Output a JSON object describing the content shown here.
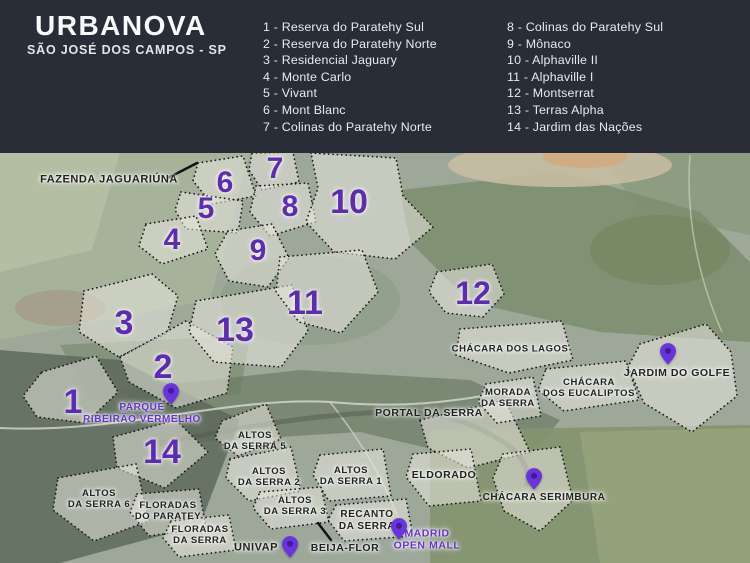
{
  "header": {
    "title": "URBANOVA",
    "subtitle": "SÃO JOSÉ DOS CAMPOS - SP",
    "bg_color": "#282d37",
    "text_color": "#fafbfc"
  },
  "legend": {
    "column1": [
      "1 - Reserva do Paratehy Sul",
      "2 - Reserva do Paratehy Norte",
      "3 - Residencial Jaguary",
      "4 - Monte Carlo",
      "5 - Vivant",
      "6 - Mont Blanc",
      "7 - Colinas do Paratehy Norte"
    ],
    "column2": [
      "8 - Colinas do Paratehy Sul",
      "9 - Mônaco",
      "10 - Alphaville II",
      "11 - Alphaville I",
      "12 - Montserrat",
      "13 - Terras Alpha",
      "14 - Jardim das Nações"
    ]
  },
  "map": {
    "accent_color": "#5c2db3",
    "pin_color": "#6a34dd",
    "pin_dot_color": "#3f1e8f",
    "outline_color": "#16171a",
    "numbers": [
      {
        "label": "1",
        "x": 73,
        "y": 402,
        "size": 34
      },
      {
        "label": "2",
        "x": 163,
        "y": 367,
        "size": 34
      },
      {
        "label": "3",
        "x": 124,
        "y": 323,
        "size": 34
      },
      {
        "label": "4",
        "x": 172,
        "y": 240,
        "size": 30
      },
      {
        "label": "5",
        "x": 206,
        "y": 209,
        "size": 30
      },
      {
        "label": "6",
        "x": 225,
        "y": 183,
        "size": 30
      },
      {
        "label": "7",
        "x": 275,
        "y": 169,
        "size": 30
      },
      {
        "label": "8",
        "x": 290,
        "y": 207,
        "size": 30
      },
      {
        "label": "9",
        "x": 258,
        "y": 251,
        "size": 30
      },
      {
        "label": "10",
        "x": 349,
        "y": 202,
        "size": 34
      },
      {
        "label": "11",
        "x": 305,
        "y": 303,
        "size": 34
      },
      {
        "label": "12",
        "x": 473,
        "y": 293,
        "size": 32
      },
      {
        "label": "13",
        "x": 235,
        "y": 330,
        "size": 34
      },
      {
        "label": "14",
        "x": 162,
        "y": 452,
        "size": 34
      }
    ],
    "labels": [
      {
        "name": "fazenda-jaguariuna-label",
        "lines": [
          "FAZENDA JAGUARIÚNA"
        ],
        "x": 109,
        "y": 180,
        "color": "dark",
        "size": 11
      },
      {
        "name": "parque-ribeirao-vermelho-label",
        "lines": [
          "PARQUE",
          "RIBEIRÃO VERMELHO"
        ],
        "x": 142,
        "y": 414,
        "color": "purple",
        "size": 10
      },
      {
        "name": "chacara-dos-lagos-label",
        "lines": [
          "CHÁCARA DOS LAGOS"
        ],
        "x": 510,
        "y": 349,
        "color": "dark",
        "size": 9.5
      },
      {
        "name": "jardim-do-golfe-label",
        "lines": [
          "JARDIM DO GOLFE"
        ],
        "x": 677,
        "y": 373,
        "color": "dark",
        "size": 10.5
      },
      {
        "name": "chacara-dos-eucaliptos-label",
        "lines": [
          "CHÁCARA",
          "DOS EUCALIPTOS"
        ],
        "x": 589,
        "y": 388,
        "color": "dark",
        "size": 9.5
      },
      {
        "name": "morada-da-serra-label",
        "lines": [
          "MORADA",
          "DA SERRA"
        ],
        "x": 508,
        "y": 398,
        "color": "dark",
        "size": 9.5
      },
      {
        "name": "portal-da-serra-label",
        "lines": [
          "PORTAL DA SERRA"
        ],
        "x": 429,
        "y": 413,
        "color": "dark",
        "size": 10.5
      },
      {
        "name": "altos-da-serra-5-label",
        "lines": [
          "ALTOS",
          "DA SERRA 5"
        ],
        "x": 255,
        "y": 441,
        "color": "dark",
        "size": 9.5
      },
      {
        "name": "altos-da-serra-2-label",
        "lines": [
          "ALTOS",
          "DA SERRA 2"
        ],
        "x": 269,
        "y": 477,
        "color": "dark",
        "size": 9.5
      },
      {
        "name": "altos-da-serra-1-label",
        "lines": [
          "ALTOS",
          "DA SERRA 1"
        ],
        "x": 351,
        "y": 476,
        "color": "dark",
        "size": 9.5
      },
      {
        "name": "eldorado-label",
        "lines": [
          "ELDORADO"
        ],
        "x": 444,
        "y": 475,
        "color": "dark",
        "size": 10.5
      },
      {
        "name": "altos-da-serra-3-label",
        "lines": [
          "ALTOS",
          "DA SERRA 3"
        ],
        "x": 295,
        "y": 506,
        "color": "dark",
        "size": 9.5
      },
      {
        "name": "recanto-da-serra-label",
        "lines": [
          "RECANTO",
          "DA SERRA"
        ],
        "x": 367,
        "y": 521,
        "color": "dark",
        "size": 10
      },
      {
        "name": "altos-da-serra-6-label",
        "lines": [
          "ALTOS",
          "DA SERRA 6"
        ],
        "x": 99,
        "y": 499,
        "color": "dark",
        "size": 9.5
      },
      {
        "name": "floradas-do-paratey-label",
        "lines": [
          "FLORADAS",
          "DO PARATEY"
        ],
        "x": 168,
        "y": 511,
        "color": "dark",
        "size": 9.5
      },
      {
        "name": "floradas-da-serra-label",
        "lines": [
          "FLORADAS",
          "DA SERRA"
        ],
        "x": 200,
        "y": 535,
        "color": "dark",
        "size": 9.5
      },
      {
        "name": "univap-label",
        "lines": [
          "UNIVAP"
        ],
        "x": 256,
        "y": 548,
        "color": "dark",
        "size": 11
      },
      {
        "name": "beija-flor-label",
        "lines": [
          "BEIJA-FLOR"
        ],
        "x": 345,
        "y": 548,
        "color": "dark",
        "size": 10.5
      },
      {
        "name": "madrid-open-mall-label",
        "lines": [
          "MADRID",
          "OPEN MALL"
        ],
        "x": 427,
        "y": 540,
        "color": "purple",
        "size": 10.5
      },
      {
        "name": "chacara-serimbura-label",
        "lines": [
          "CHÁCARA SERIMBURA"
        ],
        "x": 544,
        "y": 498,
        "color": "dark",
        "size": 10
      }
    ],
    "pins": [
      {
        "name": "parque-ribeirao-vermelho-pin",
        "x": 171,
        "y": 403
      },
      {
        "name": "jardim-do-golfe-pin",
        "x": 668,
        "y": 363
      },
      {
        "name": "chacara-serimbura-pin",
        "x": 534,
        "y": 488
      },
      {
        "name": "univap-pin",
        "x": 290,
        "y": 556
      },
      {
        "name": "madrid-open-mall-pin",
        "x": 399,
        "y": 538
      }
    ],
    "pointer_lines": [
      {
        "name": "fazenda-jaguariuna-pointer",
        "x1": 168,
        "y1": 178,
        "x2": 197,
        "y2": 163
      },
      {
        "name": "beija-flor-pointer",
        "x1": 318,
        "y1": 523,
        "x2": 331,
        "y2": 540
      }
    ],
    "regions": [
      {
        "name": "region-7-outline",
        "points": "252,153 293,152 299,182 262,190 249,170"
      },
      {
        "name": "region-6-outline",
        "points": "198,163 243,156 256,196 212,204 193,181"
      },
      {
        "name": "region-5-outline",
        "points": "181,192 243,201 238,233 186,229 175,210"
      },
      {
        "name": "region-4-outline",
        "points": "146,224 196,216 208,249 162,264 139,246"
      },
      {
        "name": "region-8-outline",
        "points": "256,186 308,183 316,222 270,236 250,212"
      },
      {
        "name": "region-10-outline",
        "points": "311,153 396,158 403,196 433,227 395,259 334,252 306,222 318,188"
      },
      {
        "name": "region-9-outline",
        "points": "228,231 272,224 289,258 268,287 229,281 215,254"
      },
      {
        "name": "region-12-outline",
        "points": "437,272 492,264 504,294 483,317 446,313 429,292"
      },
      {
        "name": "region-3-outline",
        "points": "84,291 152,274 178,296 167,333 119,357 79,332"
      },
      {
        "name": "region-2-outline",
        "points": "120,357 186,321 233,347 227,393 176,408 129,382"
      },
      {
        "name": "region-1-outline",
        "points": "42,372 96,356 118,392 86,423 37,417 23,396"
      },
      {
        "name": "region-14-outline",
        "points": "113,437 176,420 208,452 165,488 117,468"
      },
      {
        "name": "region-13-outline",
        "points": "196,301 292,285 308,331 281,367 214,362 189,332"
      },
      {
        "name": "region-11-outline",
        "points": "280,257 362,250 378,292 341,333 299,322 276,292"
      },
      {
        "name": "portal-da-serra-outline",
        "points": "420,420 505,400 530,452 468,468 428,448"
      },
      {
        "name": "altos-da-serra-5-outline",
        "points": "222,421 266,404 281,439 238,456 215,438"
      },
      {
        "name": "altos-da-serra-2-outline",
        "points": "230,459 291,447 301,491 249,501 226,478"
      },
      {
        "name": "altos-da-serra-1-outline",
        "points": "320,455 383,449 391,496 329,501 313,475"
      },
      {
        "name": "altos-da-serra-3-outline",
        "points": "260,492 321,487 329,522 271,529 253,508"
      },
      {
        "name": "altos-da-serra-6-outline",
        "points": "58,478 136,464 149,521 94,541 53,510"
      },
      {
        "name": "floradas-do-paratey-outline",
        "points": "137,494 199,489 206,528 149,536 130,512"
      },
      {
        "name": "floradas-da-serra-outline",
        "points": "171,521 229,515 236,550 179,557 163,538"
      },
      {
        "name": "recanto-da-serra-outline",
        "points": "336,505 406,499 413,536 344,541 328,520"
      },
      {
        "name": "eldorado-outline",
        "points": "413,454 471,449 481,501 429,506 406,477"
      },
      {
        "name": "morada-da-serra-outline",
        "points": "486,384 533,377 541,416 497,423 478,402"
      },
      {
        "name": "chacara-dos-lagos-outline",
        "points": "460,329 562,321 573,360 509,373 456,355"
      },
      {
        "name": "chacara-dos-eucaliptos-outline",
        "points": "546,369 626,361 639,400 564,411 538,390"
      },
      {
        "name": "jardim-do-golfe-outline",
        "points": "640,344 706,324 731,352 737,396 692,432 644,403 628,367"
      },
      {
        "name": "chacara-serimbura-outline",
        "points": "503,454 560,447 573,500 540,531 504,511 493,478"
      }
    ]
  }
}
